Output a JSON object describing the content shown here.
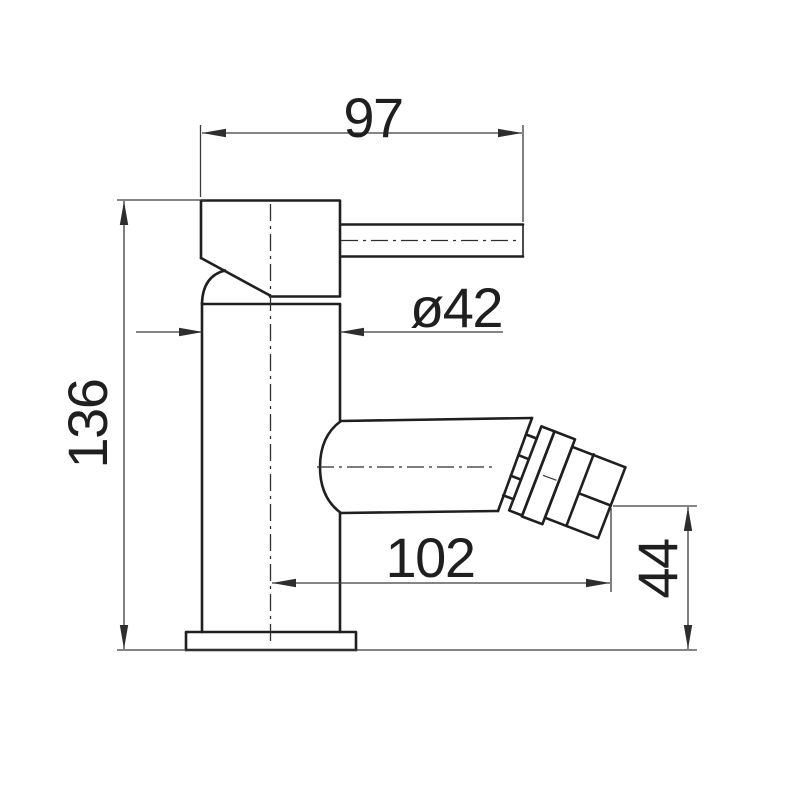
{
  "drawing": {
    "background": "#ffffff",
    "object_line_color": "#1f1f1f",
    "dimension_line_color": "#3c3c3c",
    "dimensions": {
      "top_width": {
        "label": "97"
      },
      "diameter": {
        "label": "ø42"
      },
      "height": {
        "label": "136"
      },
      "spout_reach": {
        "label": "102"
      },
      "outlet_height": {
        "label": "44"
      }
    }
  }
}
